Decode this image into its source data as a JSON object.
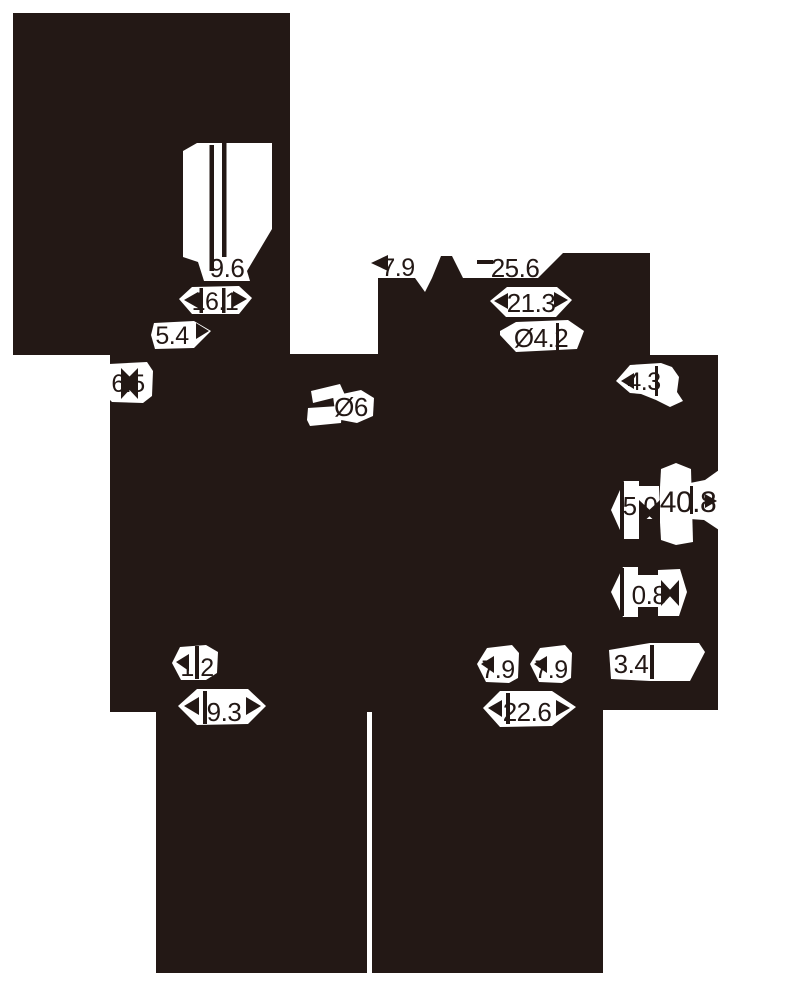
{
  "drawing": {
    "kind": "silhouetted mechanical dimension drawing",
    "ink_color": "#231815",
    "paper_color": "#ffffff"
  },
  "dimensions": [
    "9.6",
    "16.1",
    "5.4",
    "7.9",
    "25.6",
    "21.3",
    "Ø4.2",
    "4.3",
    "6.5",
    "Ø6",
    "5.0",
    "40.8",
    "0.8",
    "1.2",
    "9.3",
    "7.9",
    "7.9",
    "3.4",
    "22.6"
  ]
}
